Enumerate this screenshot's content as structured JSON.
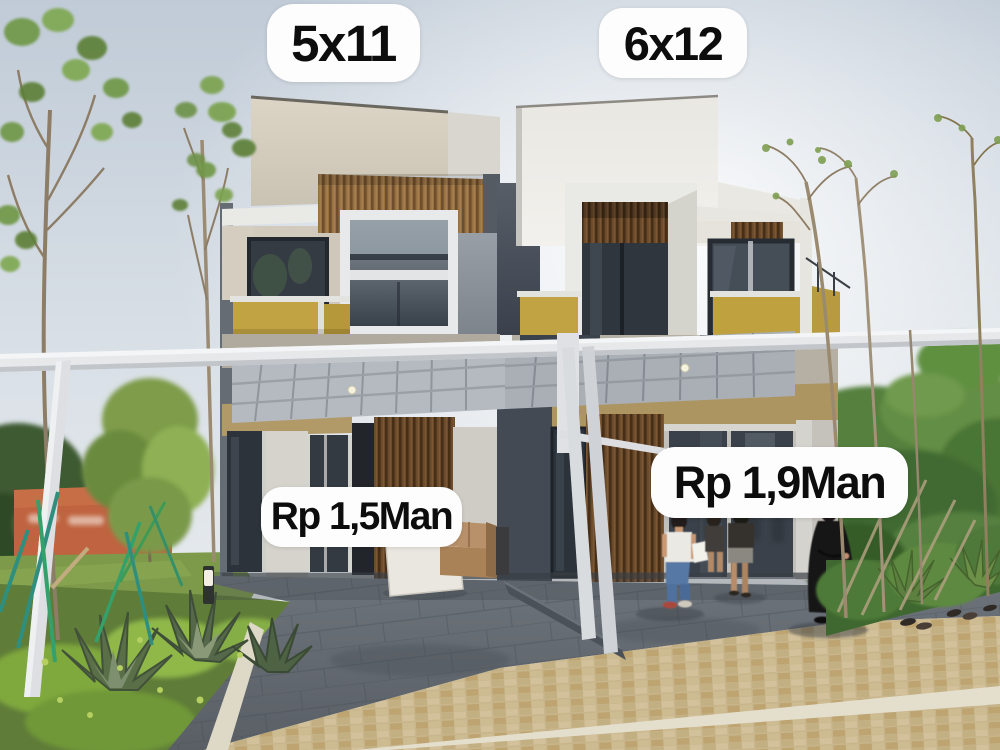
{
  "labels": {
    "left_house_size": "5x11",
    "right_house_size": "6x12",
    "left_house_price": "Rp 1,5Man",
    "right_house_price": "Rp 1,9Man"
  },
  "colors": {
    "label_background": "#fdfdfd",
    "label_text": "#0d0d0d",
    "sky_top": "#c2cdd8",
    "accent_yellow": "#c1a343",
    "wood_brown": "#6b4a2c",
    "wall_cream": "#d6cfc0",
    "wall_white": "#eceae4",
    "dark_gray_wall": "#4a515c",
    "canopy_white": "#e6e8ea",
    "driveway_gray": "#6a7076",
    "paving_tan": "#c8b58c",
    "lawn_green": "#7c9a4a",
    "orange_wall": "#bf6340",
    "netting_green": "#2f7a66"
  }
}
